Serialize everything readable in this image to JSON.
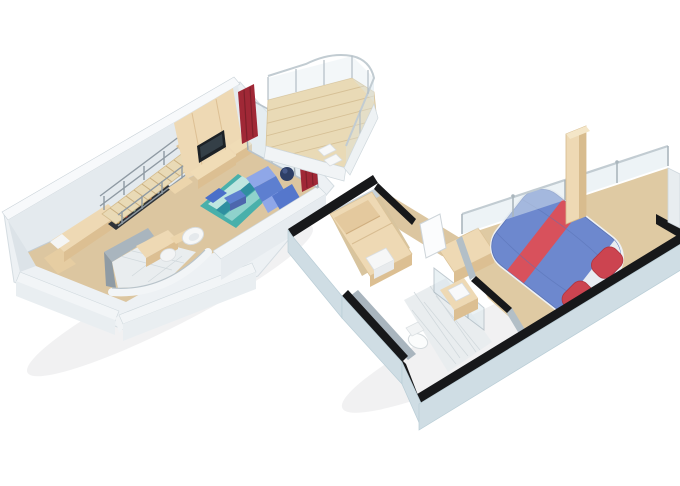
{
  "image": {
    "kind": "3d-floorplan-illustration",
    "subject": "two-level loft suite floor plan",
    "background": "#ffffff",
    "width": 680,
    "height": 486
  },
  "colors": {
    "wallFace": "#e4eaee",
    "wallTop": "#f7f9fb",
    "wallSide": "#e9eef1",
    "slab": "#edf1f4",
    "outerHull": "#cfdde4",
    "blackWall": "#17181a",
    "floorBeige": "#dcc6a0",
    "floorBedroom": "#dfcaa3",
    "deckWood": "#e9dab6",
    "plankLine": "#d6c096",
    "woodTop": "#eed9b4",
    "woodSide": "#dcbf92",
    "tileFloor": "#e9edef",
    "tileLine": "#d0d8dc",
    "glass": "#dce8ee",
    "glassFrame": "#9fabb3",
    "railMetal": "#c2ccd2",
    "curtainRed": "#a02836",
    "curtainFold": "#7e1f2a",
    "sofaBlue": "#5d7fd0",
    "sofaLight": "#8fa7e8",
    "rugTeal": "#49b0ab",
    "rugLight": "#bfe6e0",
    "rugDark": "#2f8fa0",
    "rugPatchBlue": "#4a6fc9",
    "bedBlue": "#6d88ce",
    "bedStripe": "#d8515c",
    "pillowRed": "#cc4450",
    "sheetWhite": "#e8ecf2",
    "fixtureWhite": "#f8f9fa",
    "greyWall": "#a9b5be",
    "barDark": "#2f3338",
    "chairNavy": "#2e3f66"
  },
  "upper_deck": {
    "name": "loft living level",
    "items": [
      "staircase",
      "stair-railing",
      "bar-counter",
      "bar-shelf",
      "kitchenette-cabinet",
      "tv-panel",
      "tv",
      "media-console",
      "curved-bathroom-pod",
      "desk",
      "egg-chair",
      "side-chair",
      "area-rug",
      "coffee-table",
      "lounge-sofa",
      "red-curtains",
      "glass-balcony-wall",
      "balcony-deck",
      "balcony-railing",
      "balcony-stools",
      "round-chair",
      "window-chair"
    ]
  },
  "lower_deck": {
    "name": "bedroom level",
    "items": [
      "wardrobe",
      "mini-fridge",
      "entry-door",
      "vanity-desk",
      "bathroom-tile-floor",
      "toilet",
      "shower-glass",
      "sink-counter",
      "double-bed",
      "bed-stripe-runner",
      "red-pillows",
      "glass-railing",
      "timber-column",
      "hull-walls"
    ]
  }
}
